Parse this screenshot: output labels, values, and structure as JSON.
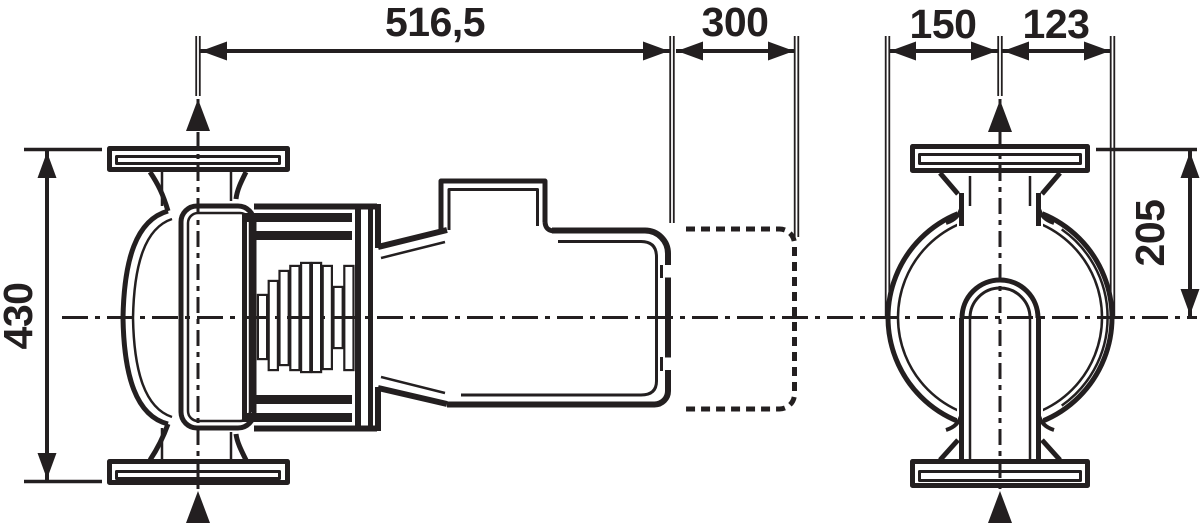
{
  "drawing": {
    "background": "#ffffff",
    "line_color": "#231f20",
    "views": {
      "side_view": "pump-side-view",
      "end_view": "pump-end-view"
    },
    "dimensions": {
      "overall_length": {
        "label": "516,5"
      },
      "clearance_length": {
        "label": "300"
      },
      "axis_to_left": {
        "label": "150"
      },
      "axis_to_right": {
        "label": "123"
      },
      "overall_height": {
        "label": "430"
      },
      "axis_to_flange_top": {
        "label": "205"
      }
    }
  }
}
